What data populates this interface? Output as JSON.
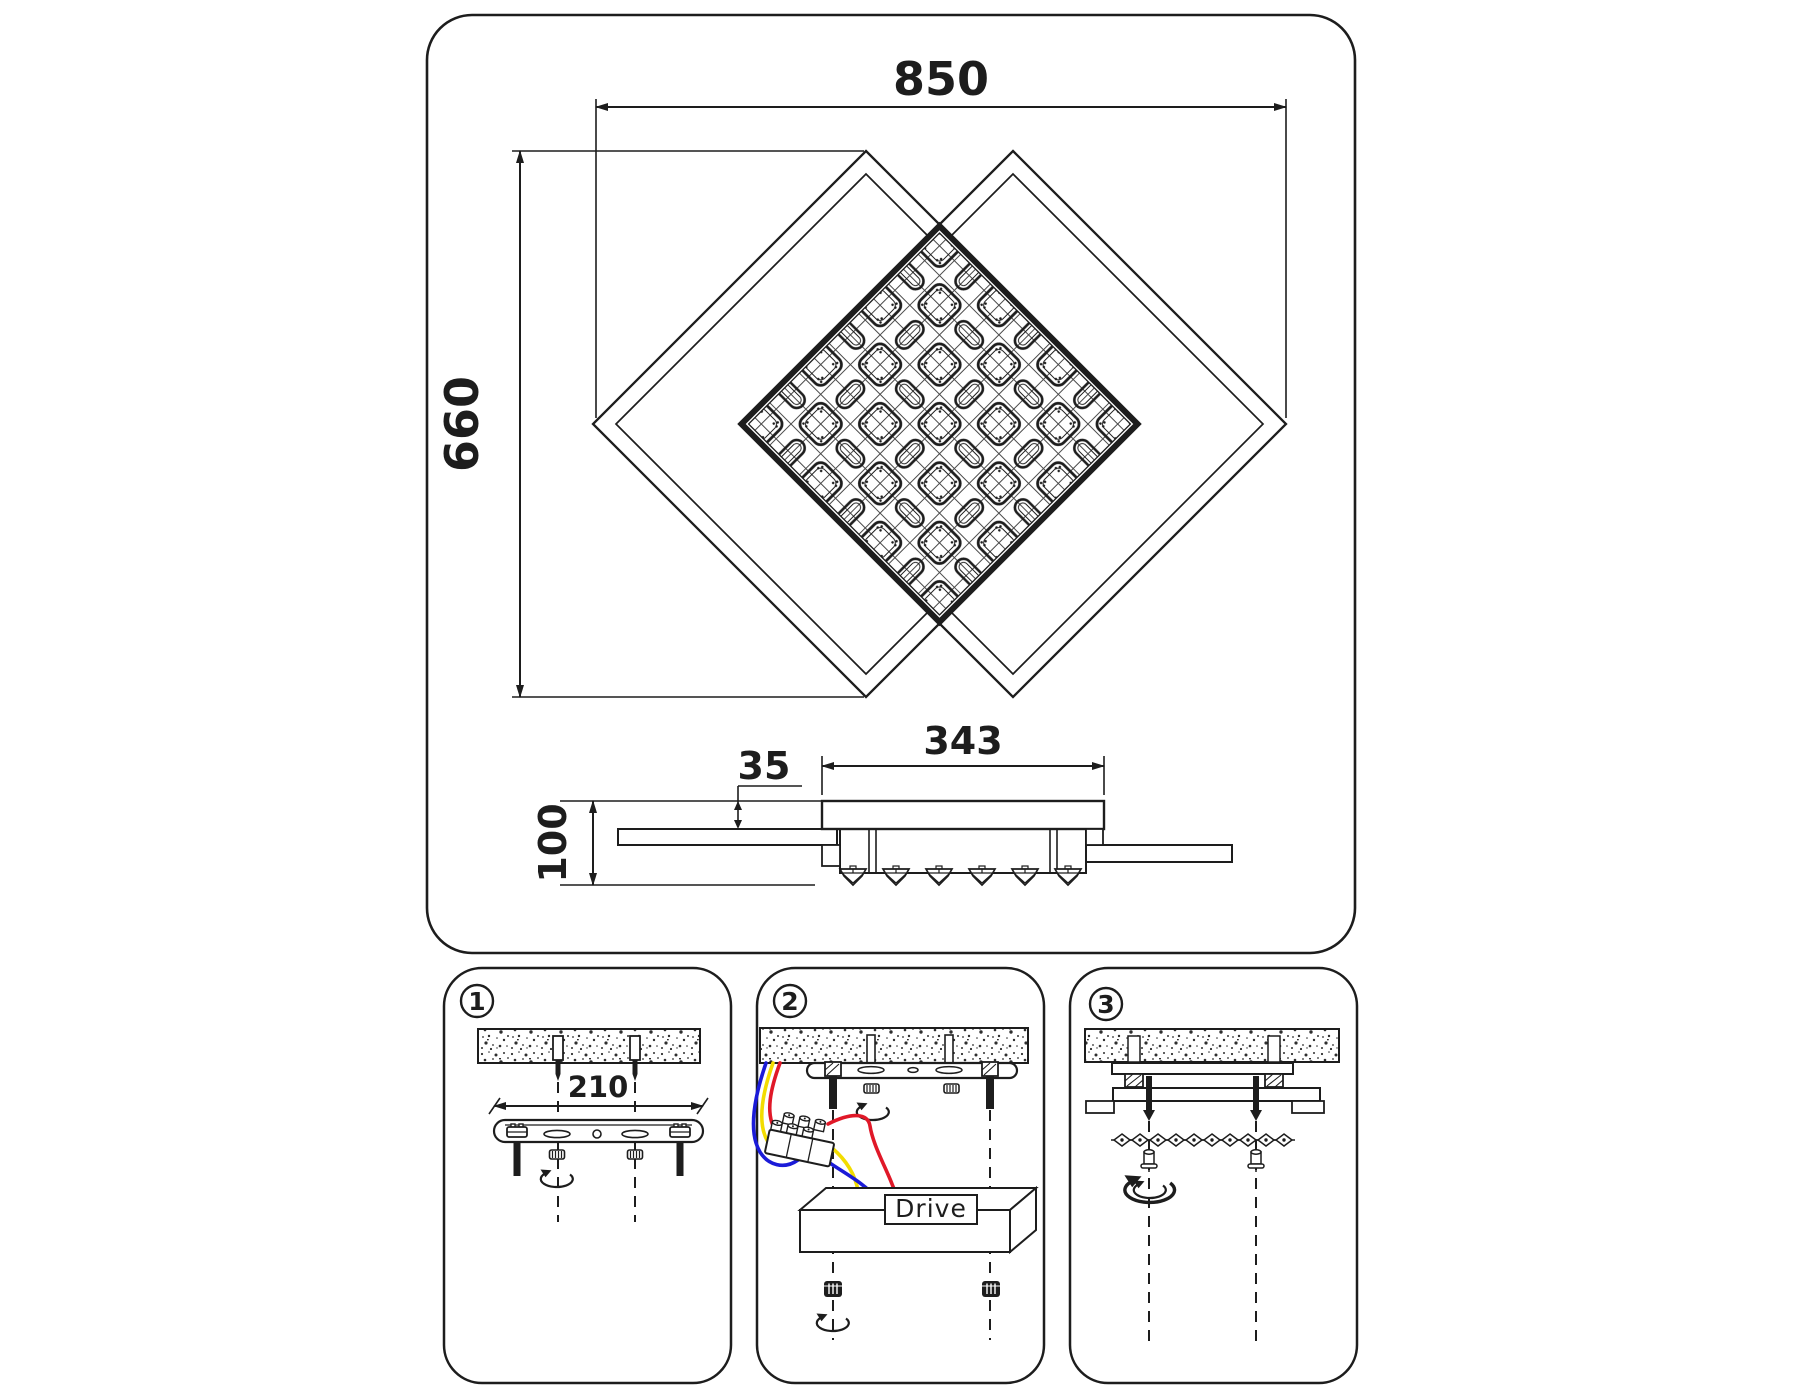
{
  "main_view": {
    "dim_width": "850",
    "dim_height": "660"
  },
  "side_view": {
    "dim_canopy": "343",
    "dim_offset": "35",
    "dim_height": "100"
  },
  "steps": [
    {
      "number": "1",
      "dim_bracket": "210"
    },
    {
      "number": "2",
      "driver_label": "Drive"
    },
    {
      "number": "3"
    }
  ],
  "colors": {
    "line": "#1d1d1d",
    "wire_red": "#e01828",
    "wire_yellow": "#f2dc00",
    "wire_blue": "#1b1bd8"
  }
}
